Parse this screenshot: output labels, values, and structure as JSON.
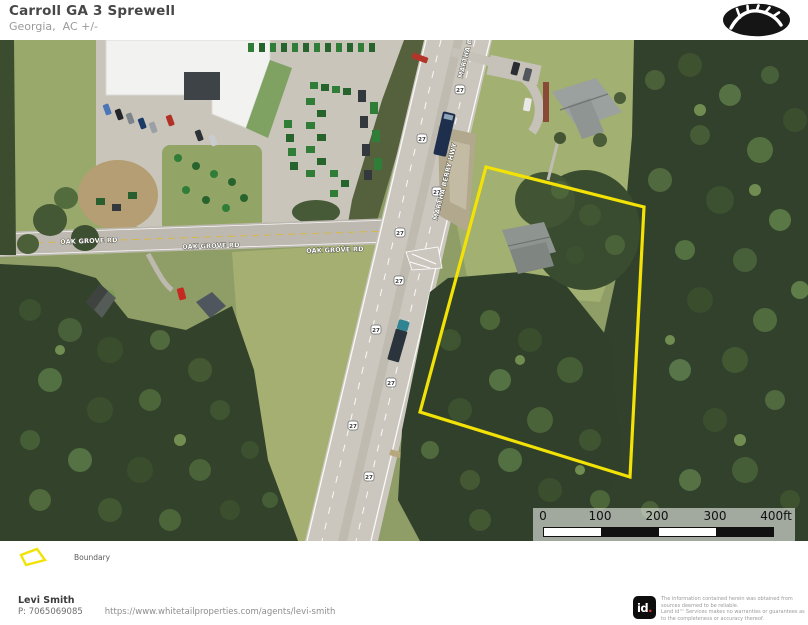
{
  "header": {
    "title": "Carroll GA 3 Sprewell",
    "subtitle": "Georgia,  AC +/-"
  },
  "map": {
    "road_labels": {
      "oak_grove": "OAK GROVE RD",
      "martha_berry": "MARTHA BERRY HWY"
    },
    "route_shield": "27",
    "boundary_color": "#F2E206"
  },
  "scale_bar": {
    "ticks": [
      "0",
      "100",
      "200",
      "300",
      "400ft"
    ]
  },
  "legend": {
    "boundary_label": "Boundary"
  },
  "footer": {
    "agent_name": "Levi Smith",
    "agent_phone": "P: 7065069085",
    "agent_url": "https://www.whitetailproperties.com/agents/levi-smith",
    "brand": {
      "logo_text": "id",
      "logo_dot": "."
    },
    "disclaimer_line1": "The information contained herein was obtained from sources deemed to be reliable.",
    "disclaimer_line2": "Land id™ Services makes no warranties or guarantees as to the completeness or accuracy thereof."
  }
}
